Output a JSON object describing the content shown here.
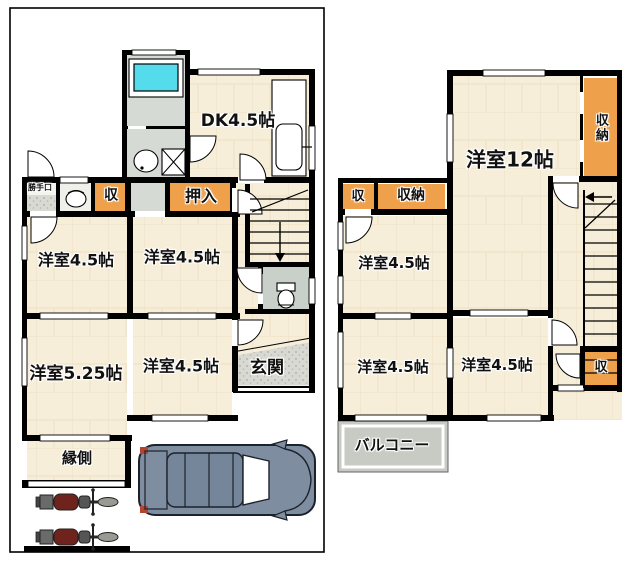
{
  "floor1": {
    "dk": "DK4.5帖",
    "oshiire": "押入",
    "shu": "収",
    "katteguchi": "勝手口",
    "room_nw": "洋室4.5帖",
    "room_n_center": "洋室4.5帖",
    "room_sw": "洋室5.25帖",
    "room_s_center": "洋室4.5帖",
    "genkan": "玄関",
    "engawa": "縁側"
  },
  "floor2": {
    "main_room": "洋室12帖",
    "shuno_east": "収納",
    "shu_west": "収",
    "shuno_west": "収納",
    "room_nw": "洋室4.5帖",
    "room_sw": "洋室4.5帖",
    "room_se": "洋室4.5帖",
    "shu_se": "収",
    "balcony": "バルコニー"
  },
  "colors": {
    "room_fill": "#f7eed9",
    "closet_fill": "#efa04a",
    "bath_fill": "#d5dad4",
    "tub_fill": "#55dcec",
    "genkan_fill": "#d9d9d3",
    "balcony_fill": "#c8cac4",
    "wall": "#000000",
    "car_body": "#7e8da0",
    "text": "#111111"
  }
}
